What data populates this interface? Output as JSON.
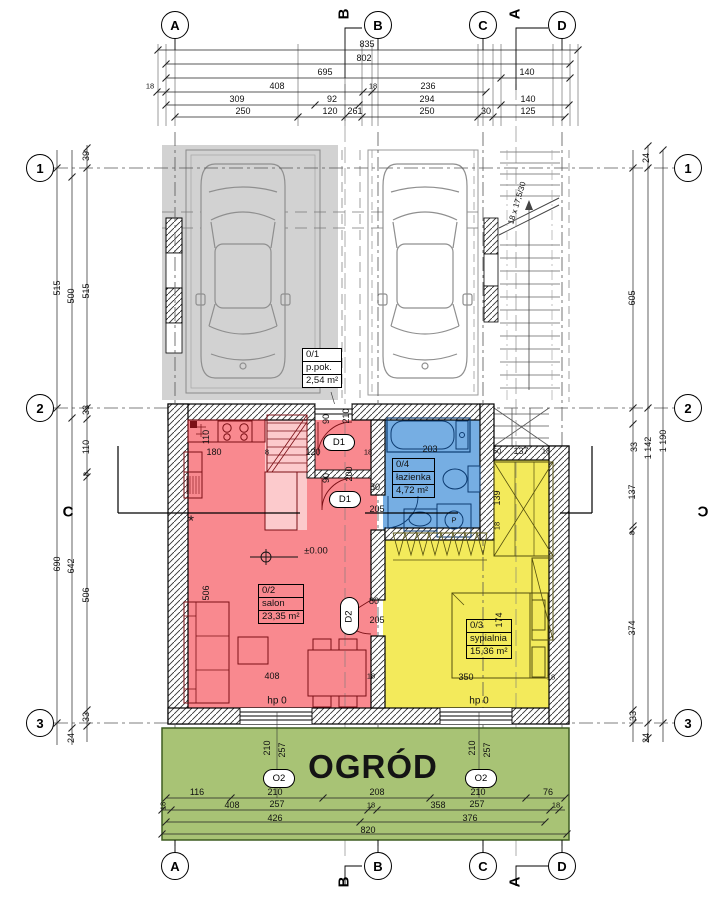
{
  "rooms": {
    "garage_unit": {
      "id": "0/1",
      "name": "p.pok.",
      "area": "2,54 m²"
    },
    "salon": {
      "id": "0/2",
      "name": "salon",
      "area": "23,35 m²"
    },
    "bedroom": {
      "id": "0/3",
      "name": "sypialnia",
      "area": "15,36 m²"
    },
    "bathroom": {
      "id": "0/4",
      "name": "łazienka",
      "area": "4,72 m²"
    }
  },
  "garden": {
    "title": "OGRÓD"
  },
  "colors": {
    "salon_fill": "#f9898f",
    "bathroom_fill": "#76aee3",
    "bedroom_fill": "#f3ea5b",
    "garden_fill": "#a8c375",
    "garage_fill": "#d2d2d2"
  },
  "grid_markers": [
    {
      "label": "A",
      "x": 175,
      "y": 25
    },
    {
      "label": "B",
      "x": 378,
      "y": 25
    },
    {
      "label": "C",
      "x": 483,
      "y": 25
    },
    {
      "label": "D",
      "x": 562,
      "y": 25
    },
    {
      "label": "1",
      "x": 40,
      "y": 168
    },
    {
      "label": "2",
      "x": 40,
      "y": 408
    },
    {
      "label": "3",
      "x": 40,
      "y": 723
    },
    {
      "label": "1",
      "x": 688,
      "y": 168
    },
    {
      "label": "2",
      "x": 688,
      "y": 408
    },
    {
      "label": "3",
      "x": 688,
      "y": 723
    },
    {
      "label": "A",
      "x": 175,
      "y": 866
    },
    {
      "label": "B",
      "x": 378,
      "y": 866
    },
    {
      "label": "C",
      "x": 483,
      "y": 866
    },
    {
      "label": "D",
      "x": 562,
      "y": 866
    }
  ],
  "section_markers": [
    {
      "label": "B",
      "x": 344,
      "y": 14,
      "r": -90
    },
    {
      "label": "A",
      "x": 515,
      "y": 14,
      "r": -90
    },
    {
      "label": "C",
      "x": 68,
      "y": 512,
      "r": 0
    },
    {
      "label": "C",
      "x": 703,
      "y": 512,
      "r": 0,
      "flip": true
    },
    {
      "label": "B",
      "x": 344,
      "y": 882,
      "r": -90
    },
    {
      "label": "A",
      "x": 515,
      "y": 882,
      "r": -90
    }
  ],
  "window_markers": [
    {
      "label": "O2",
      "x": 263,
      "y": 769,
      "w": 30,
      "h": 17
    },
    {
      "label": "O2",
      "x": 465,
      "y": 769,
      "w": 30,
      "h": 17
    }
  ],
  "door_markers": [
    {
      "label": "D1",
      "x": 323,
      "y": 434,
      "w": 30,
      "h": 15
    },
    {
      "label": "D1",
      "x": 329,
      "y": 491,
      "w": 30,
      "h": 15
    },
    {
      "label": "D2",
      "x": 340,
      "y": 597,
      "w": 17,
      "h": 36,
      "rot": -90
    }
  ],
  "stair_note": "18 x 17,5/30",
  "dim_texts": [
    {
      "t": "835",
      "x": 367,
      "y": 44
    },
    {
      "t": "802",
      "x": 364,
      "y": 58
    },
    {
      "t": "695",
      "x": 325,
      "y": 72
    },
    {
      "t": "140",
      "x": 527,
      "y": 72
    },
    {
      "t": "18",
      "x": 150,
      "y": 86,
      "s": 7.5
    },
    {
      "t": "408",
      "x": 277,
      "y": 86
    },
    {
      "t": "18",
      "x": 373,
      "y": 86,
      "s": 7.5
    },
    {
      "t": "236",
      "x": 428,
      "y": 86
    },
    {
      "t": "309",
      "x": 237,
      "y": 99
    },
    {
      "t": "92",
      "x": 332,
      "y": 99
    },
    {
      "t": "294",
      "x": 427,
      "y": 99
    },
    {
      "t": "140",
      "x": 528,
      "y": 99
    },
    {
      "t": "250",
      "x": 243,
      "y": 111
    },
    {
      "t": "120",
      "x": 330,
      "y": 111
    },
    {
      "t": "261",
      "x": 355,
      "y": 111
    },
    {
      "t": "250",
      "x": 427,
      "y": 111
    },
    {
      "t": "30",
      "x": 486,
      "y": 111
    },
    {
      "t": "125",
      "x": 528,
      "y": 111
    },
    {
      "t": "39",
      "x": 86,
      "y": 156,
      "r": -90
    },
    {
      "t": "515",
      "x": 57,
      "y": 288,
      "r": -90
    },
    {
      "t": "500",
      "x": 71,
      "y": 296,
      "r": -90
    },
    {
      "t": "515",
      "x": 86,
      "y": 291,
      "r": -90
    },
    {
      "t": "33",
      "x": 86,
      "y": 410,
      "r": -90
    },
    {
      "t": "110",
      "x": 86,
      "y": 447,
      "r": -90
    },
    {
      "t": "8",
      "x": 86,
      "y": 474,
      "r": -90,
      "s": 7.5
    },
    {
      "t": "690",
      "x": 57,
      "y": 564,
      "r": -90
    },
    {
      "t": "642",
      "x": 71,
      "y": 566,
      "r": -90
    },
    {
      "t": "506",
      "x": 86,
      "y": 595,
      "r": -90
    },
    {
      "t": "33",
      "x": 86,
      "y": 717,
      "r": -90
    },
    {
      "t": "24",
      "x": 71,
      "y": 738,
      "r": -90
    },
    {
      "t": "24",
      "x": 646,
      "y": 158,
      "r": -90
    },
    {
      "t": "605",
      "x": 632,
      "y": 298,
      "r": -90
    },
    {
      "t": "33",
      "x": 634,
      "y": 447,
      "r": -90
    },
    {
      "t": "1 142",
      "x": 648,
      "y": 448,
      "r": -90
    },
    {
      "t": "1 190",
      "x": 663,
      "y": 441,
      "r": -90
    },
    {
      "t": "137",
      "x": 632,
      "y": 492,
      "r": -90
    },
    {
      "t": "8",
      "x": 632,
      "y": 533,
      "r": -90,
      "s": 7.5
    },
    {
      "t": "374",
      "x": 632,
      "y": 628,
      "r": -90
    },
    {
      "t": "33",
      "x": 633,
      "y": 716,
      "r": -90
    },
    {
      "t": "24",
      "x": 646,
      "y": 738,
      "r": -90
    },
    {
      "t": "110",
      "x": 206,
      "y": 437,
      "r": -90
    },
    {
      "t": "180",
      "x": 214,
      "y": 452
    },
    {
      "t": "8",
      "x": 267,
      "y": 452,
      "s": 7.5
    },
    {
      "t": "120",
      "x": 313,
      "y": 452
    },
    {
      "t": "18",
      "x": 368,
      "y": 452,
      "s": 7.5
    },
    {
      "t": "90",
      "x": 326,
      "y": 419,
      "r": -90
    },
    {
      "t": "210",
      "x": 346,
      "y": 416,
      "r": -90
    },
    {
      "t": "90",
      "x": 326,
      "y": 478,
      "r": -90
    },
    {
      "t": "200",
      "x": 349,
      "y": 474,
      "r": -90
    },
    {
      "t": "80",
      "x": 375,
      "y": 487
    },
    {
      "t": "205",
      "x": 377,
      "y": 509
    },
    {
      "t": "506",
      "x": 206,
      "y": 593,
      "r": -90
    },
    {
      "t": "408",
      "x": 272,
      "y": 676
    },
    {
      "t": "18",
      "x": 371,
      "y": 676,
      "s": 7.5
    },
    {
      "t": "hp 0",
      "x": 277,
      "y": 701,
      "s": 10
    },
    {
      "t": "±0.00",
      "x": 316,
      "y": 551,
      "s": 9.5
    },
    {
      "t": "*",
      "x": 191,
      "y": 521,
      "s": 15
    },
    {
      "t": "80",
      "x": 374,
      "y": 601
    },
    {
      "t": "205",
      "x": 377,
      "y": 620
    },
    {
      "t": "203",
      "x": 430,
      "y": 449
    },
    {
      "t": "P",
      "x": 454,
      "y": 520,
      "s": 7.5
    },
    {
      "t": "50",
      "x": 497,
      "y": 451,
      "s": 7.5
    },
    {
      "t": "137",
      "x": 521,
      "y": 451
    },
    {
      "t": "18",
      "x": 546,
      "y": 451,
      "s": 7.5
    },
    {
      "t": "139",
      "x": 497,
      "y": 498,
      "r": -90
    },
    {
      "t": "18",
      "x": 497,
      "y": 526,
      "r": -90,
      "s": 7.5
    },
    {
      "t": "174",
      "x": 499,
      "y": 620,
      "r": -90
    },
    {
      "t": "350",
      "x": 466,
      "y": 677
    },
    {
      "t": "18",
      "x": 551,
      "y": 677,
      "s": 7.5
    },
    {
      "t": "hp 0",
      "x": 479,
      "y": 701,
      "s": 10
    },
    {
      "t": "18 x 17,5/30",
      "x": 517,
      "y": 203,
      "r": -73,
      "s": 8
    },
    {
      "t": "210",
      "x": 267,
      "y": 748,
      "r": -90
    },
    {
      "t": "257",
      "x": 282,
      "y": 750,
      "r": -90
    },
    {
      "t": "210",
      "x": 472,
      "y": 748,
      "r": -90
    },
    {
      "t": "257",
      "x": 487,
      "y": 750,
      "r": -90
    },
    {
      "t": "116",
      "x": 197,
      "y": 792
    },
    {
      "t": "210",
      "x": 275,
      "y": 792
    },
    {
      "t": "208",
      "x": 377,
      "y": 792
    },
    {
      "t": "210",
      "x": 478,
      "y": 792
    },
    {
      "t": "76",
      "x": 548,
      "y": 792
    },
    {
      "t": "18",
      "x": 163,
      "y": 806,
      "r": -90,
      "s": 7.5
    },
    {
      "t": "408",
      "x": 232,
      "y": 805
    },
    {
      "t": "257",
      "x": 277,
      "y": 804
    },
    {
      "t": "18",
      "x": 371,
      "y": 805,
      "s": 7.5
    },
    {
      "t": "358",
      "x": 438,
      "y": 805
    },
    {
      "t": "257",
      "x": 477,
      "y": 804
    },
    {
      "t": "18",
      "x": 556,
      "y": 805,
      "s": 7.5
    },
    {
      "t": "426",
      "x": 275,
      "y": 818
    },
    {
      "t": "376",
      "x": 470,
      "y": 818
    },
    {
      "t": "820",
      "x": 368,
      "y": 830
    }
  ]
}
